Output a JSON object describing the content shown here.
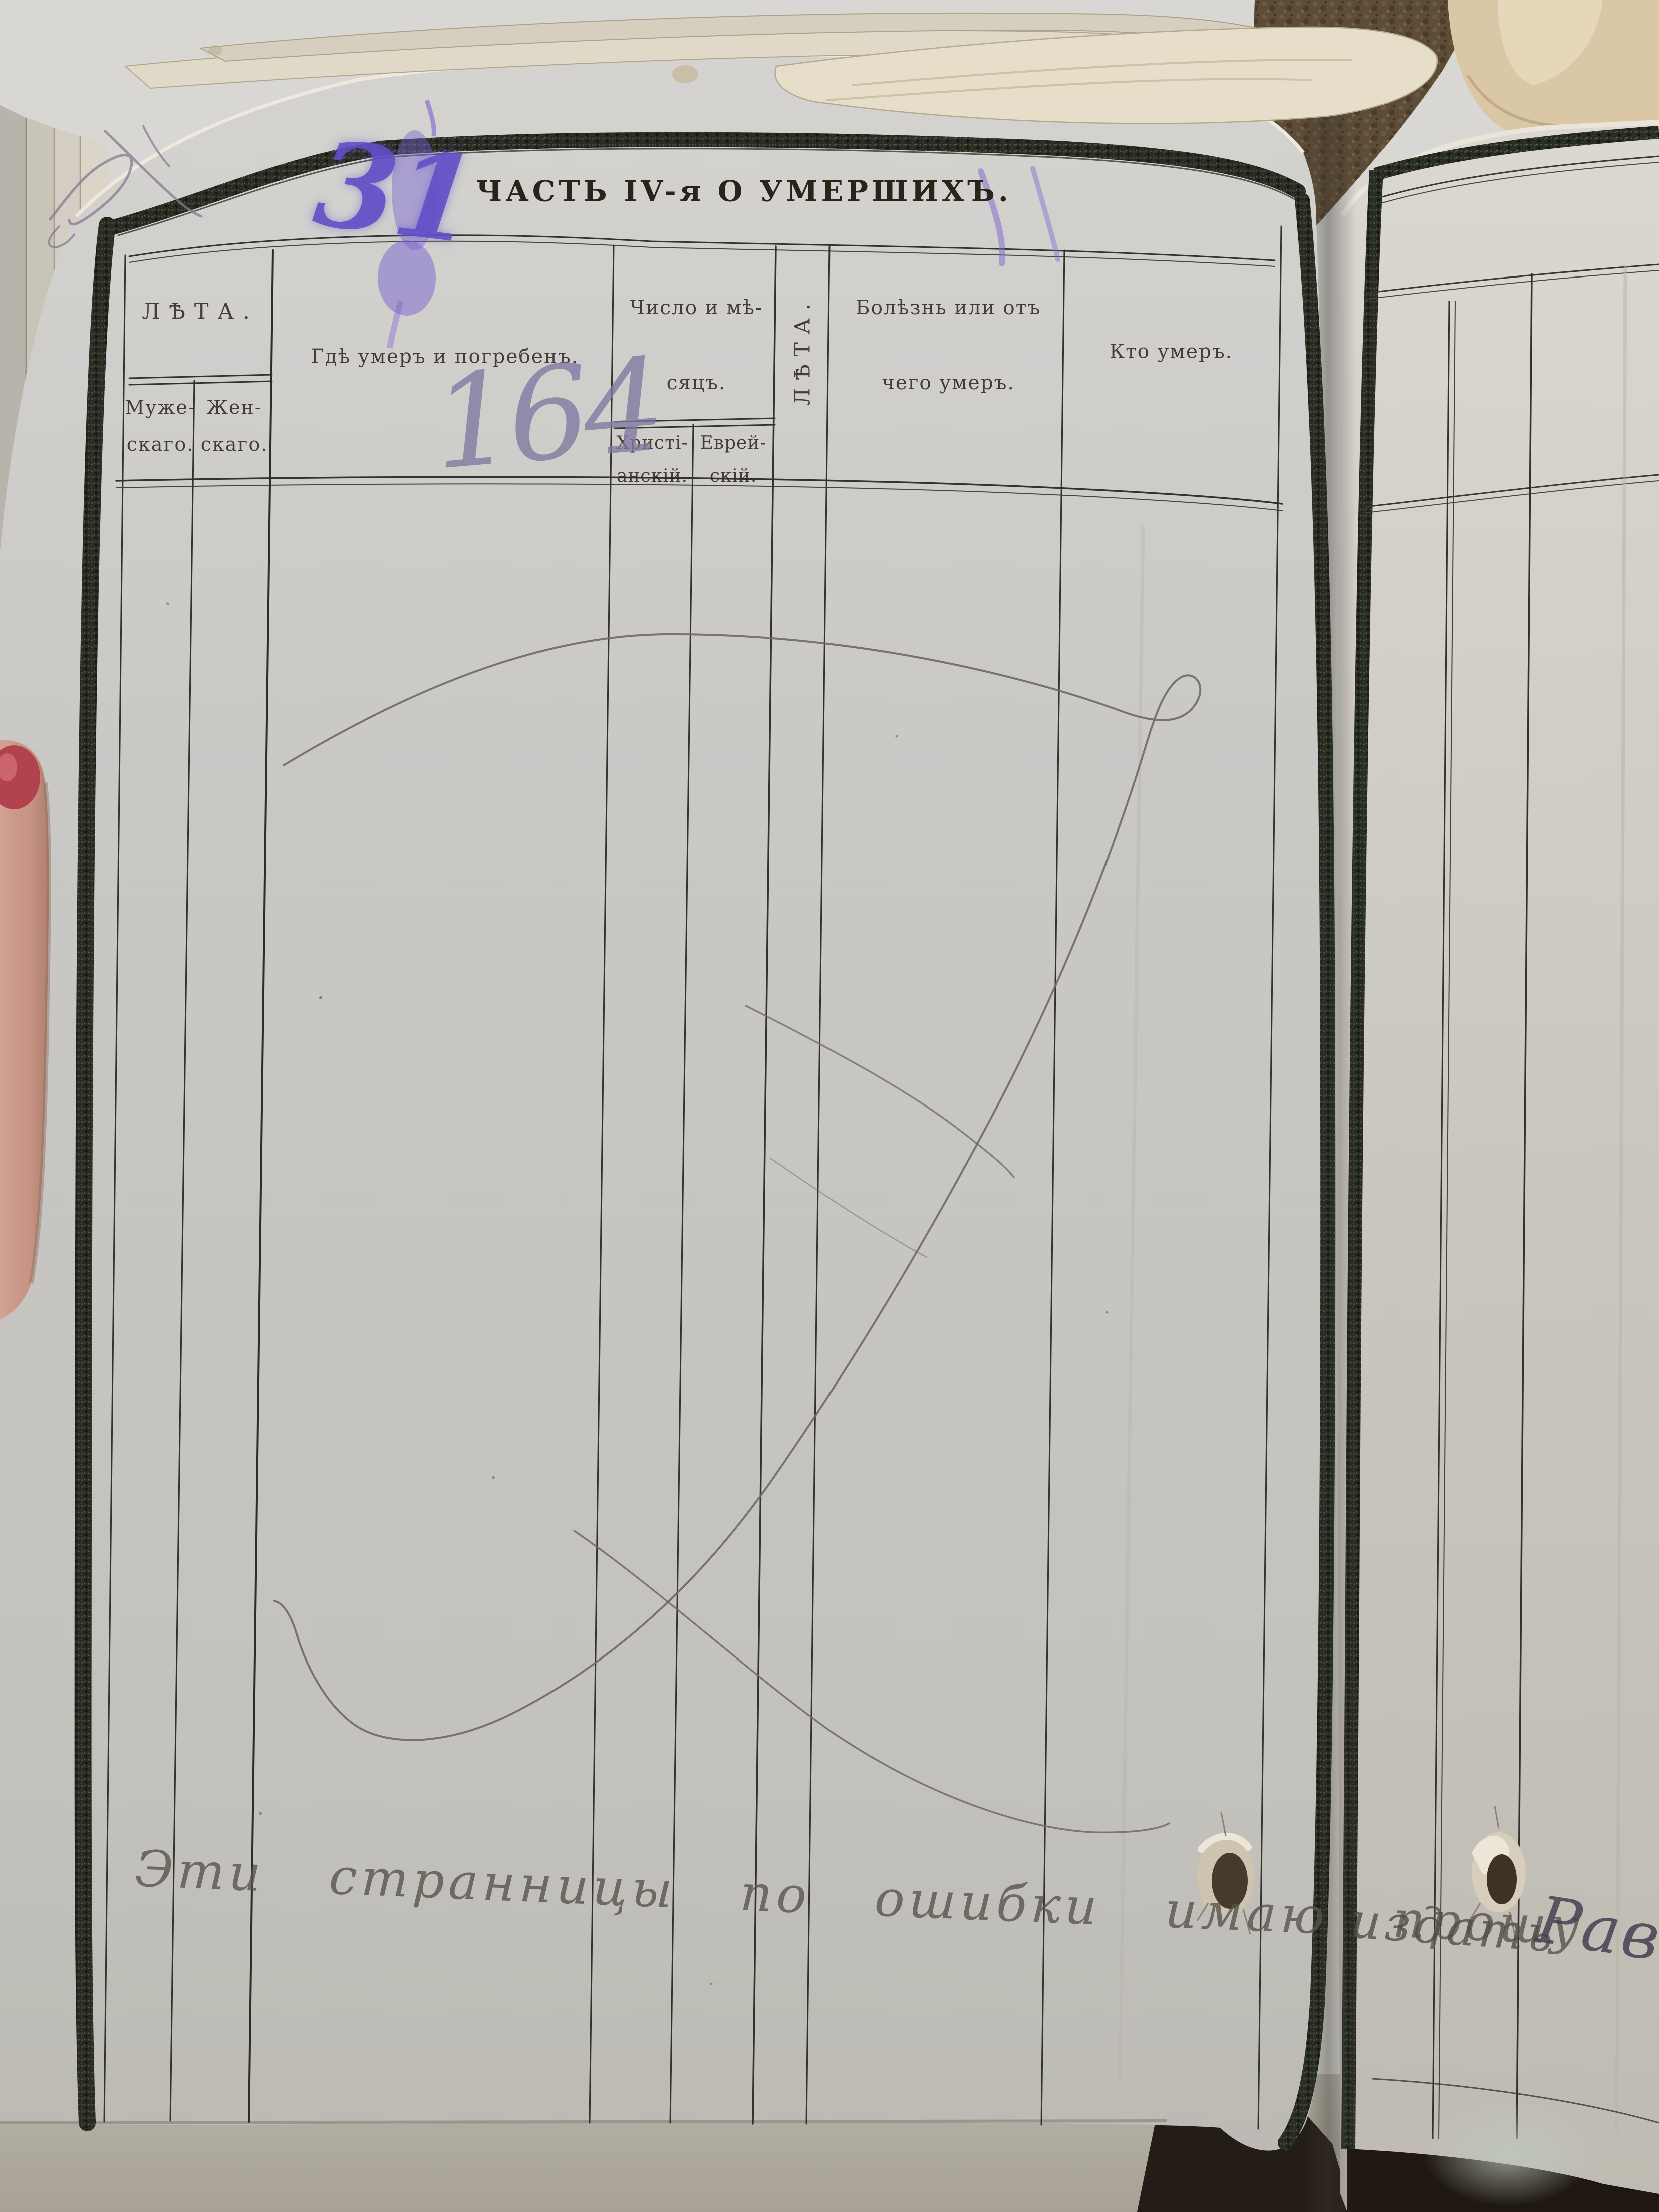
{
  "title": "ЧАСТЬ IV-я О УМЕРШИХЪ.",
  "table": {
    "age_group": "ЛѢТА.",
    "age_male": [
      "Муже-",
      "скаго."
    ],
    "age_female": [
      "Жен-",
      "скаго."
    ],
    "where_died": "Гдѣ умеръ и погребенъ.",
    "date_group": [
      "Число и мѣ-",
      "сяцъ."
    ],
    "date_christian": [
      "Христі-",
      "анскій."
    ],
    "date_jewish": [
      "Еврей-",
      "скій."
    ],
    "age_vertical": "ЛѢТА.",
    "cause_of_death": [
      "Болѣзнь или отъ",
      "чего умеръ."
    ],
    "who_died": "Кто умеръ."
  },
  "handwriting": {
    "corner_numeral": "31",
    "page_number": "164",
    "bottom_note": "Эти странницы по ошибки имаю прошу",
    "bottom_note_continued": "издать",
    "next_page_text": "Равв",
    "ink_color": "#6b54c6",
    "pencil_color": "#6f6a63"
  }
}
